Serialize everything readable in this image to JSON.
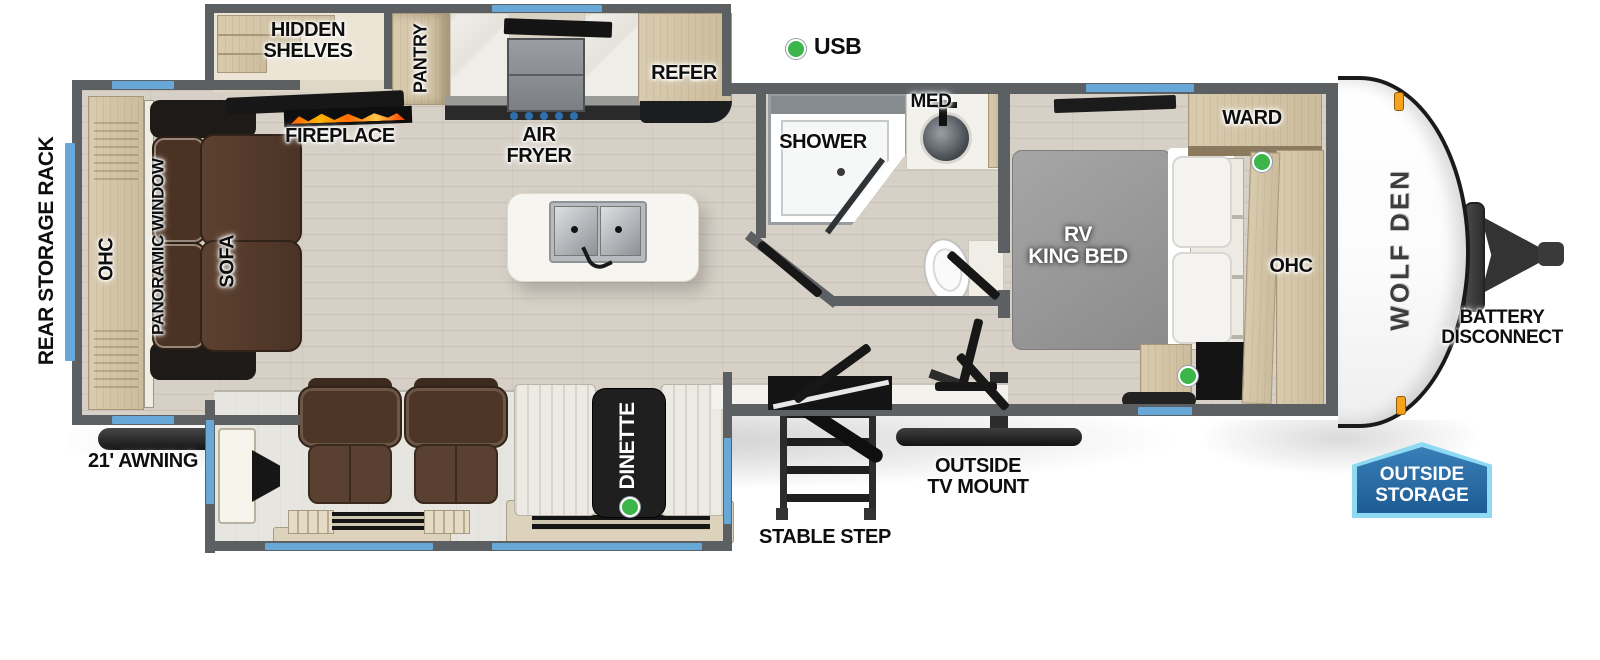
{
  "legend": {
    "usb": "USB"
  },
  "exterior": {
    "rear_storage_rack": "REAR STORAGE RACK",
    "awning": "21' AWNING",
    "stable_step": "STABLE STEP",
    "outside_tv_mount": "OUTSIDE\nTV MOUNT",
    "battery_disconnect": "BATTERY\nDISCONNECT",
    "outside_storage": "OUTSIDE\nSTORAGE",
    "brand": "WOLF DEN"
  },
  "living": {
    "hidden_shelves": "HIDDEN\nSHELVES",
    "pantry": "PANTRY",
    "fireplace": "FIREPLACE",
    "air_fryer": "AIR\nFRYER",
    "refer": "REFER",
    "ohc": "OHC",
    "panoramic_window": "PANORAMIC WINDOW",
    "sofa": "SOFA",
    "dinette": "DINETTE"
  },
  "bath": {
    "shower": "SHOWER",
    "med": "MED"
  },
  "bedroom": {
    "bed": "RV\nKING BED",
    "ward": "WARD",
    "ohc": "OHC"
  },
  "colors": {
    "accent_blue": "#68a8d8",
    "usb_green": "#3cb54a",
    "clearance_orange": "#f6a21d",
    "badge_fill": "#2a6da9",
    "badge_border": "#8fd9f3",
    "wall_gray": "#5d6063"
  }
}
